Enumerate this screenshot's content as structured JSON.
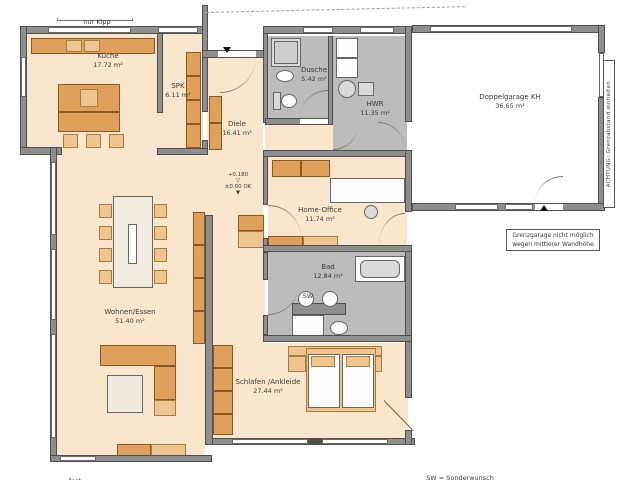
{
  "colors": {
    "wall": "#8e8e8e",
    "floor_beige": "#f9e6cc",
    "floor_gray": "#bcbcbc",
    "furniture_orange": "#dfa05c",
    "furniture_light": "#eec491"
  },
  "rooms": {
    "kueche": {
      "name": "Küche",
      "area": "17.72 m²"
    },
    "spk": {
      "name": "SPK",
      "area": "6.11 m²"
    },
    "diele": {
      "name": "Diele",
      "area": "16.41 m²"
    },
    "dusche": {
      "name": "Dusche",
      "area": "5.42 m²"
    },
    "hwr": {
      "name": "HWR",
      "area": "11.35 m²"
    },
    "garage": {
      "name": "Doppelgarage KH",
      "area": "36.65 m²"
    },
    "home_office": {
      "name": "Home-Office",
      "area": "11.74 m²"
    },
    "bad": {
      "name": "Bad",
      "area": "12.84 m²"
    },
    "wohnen": {
      "name": "Wohnen/Essen",
      "area": "51.40 m²"
    },
    "schlafen": {
      "name": "Schlafen /Ankleide",
      "area": "27.44 m²"
    }
  },
  "annotations": {
    "nur_kipp": "nur Kipp",
    "fest": "fest",
    "sw_marker": "SW",
    "legend": "SW = Sonderwunsch",
    "achtung": "ACHTUNG: Grenzabstand einhalten",
    "note_line1": "Grenzgarage nicht möglich",
    "note_line2": "wegen mittlerer Wandhöhe",
    "level_upper": "+0.180",
    "level_lower": "±0.00 OK",
    "marker_open": "▽",
    "marker_filled": "▼"
  }
}
